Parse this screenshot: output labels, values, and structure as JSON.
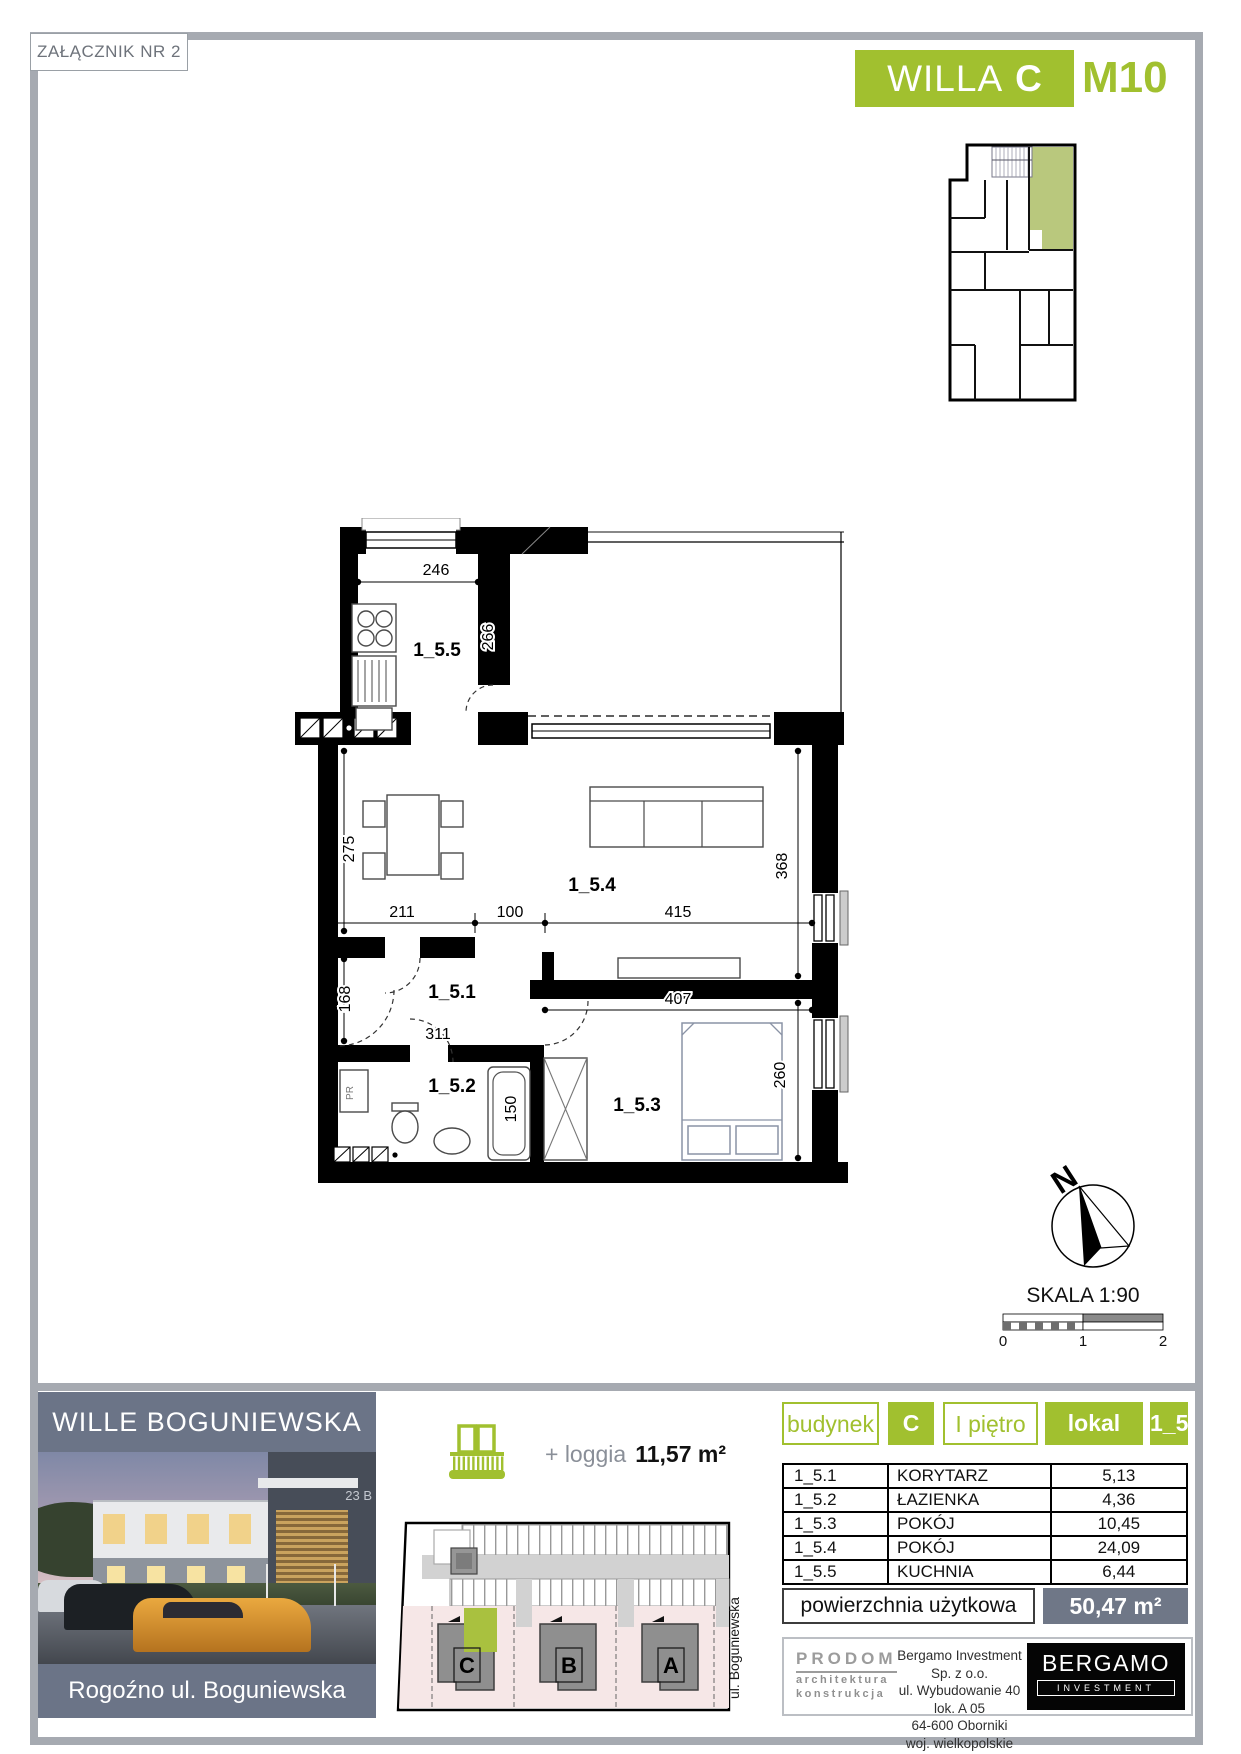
{
  "page": {
    "attachment": "ZAŁĄCZNIK NR 2"
  },
  "header": {
    "project": "WILLA",
    "building": "C",
    "unit": "M10"
  },
  "floorplan": {
    "rooms": {
      "kitchen": "1_5.5",
      "living": "1_5.4",
      "hall": "1_5.1",
      "bath": "1_5.2",
      "bedroom": "1_5.3"
    },
    "dims": {
      "kitchen_w": "246",
      "kitchen_h": "266",
      "living_h_left": "275",
      "living_h_right": "368",
      "seg_left": "211",
      "seg_mid": "100",
      "seg_right": "415",
      "hall_h": "168",
      "hall_w": "311",
      "tub": "150",
      "bedroom_w": "407",
      "bedroom_h": "260"
    },
    "closet": "PR"
  },
  "compass": {
    "north": "N"
  },
  "scalebar": {
    "label": "SKALA 1:90",
    "t0": "0",
    "t1": "1",
    "t2": "2"
  },
  "project": {
    "name": "WILLE BOGUNIEWSKA",
    "location": "Rogoźno ul. Boguniewska",
    "photo_sign": "23 B"
  },
  "loggia": {
    "label": "+ loggia",
    "area": "11,57 m²"
  },
  "siteplan": {
    "street": "ul. Boguniewska",
    "b1": "C",
    "b2": "B",
    "b3": "A"
  },
  "unit": {
    "building_label": "budynek",
    "building": "C",
    "floor": "I piętro",
    "unit_label": "lokal",
    "unit": "1_5",
    "rooms": [
      {
        "id": "1_5.1",
        "name": "KORYTARZ",
        "area": "5,13"
      },
      {
        "id": "1_5.2",
        "name": "ŁAZIENKA",
        "area": "4,36"
      },
      {
        "id": "1_5.3",
        "name": "POKÓJ",
        "area": "10,45"
      },
      {
        "id": "1_5.4",
        "name": "POKÓJ",
        "area": "24,09"
      },
      {
        "id": "1_5.5",
        "name": "KUCHNIA",
        "area": "6,44"
      }
    ],
    "total_label": "powierzchnia użytkowa",
    "total": "50,47 m²"
  },
  "footer": {
    "studio": {
      "name": "PRODOM",
      "sub1": "architektura",
      "sub2": "konstrukcja"
    },
    "developer": [
      "Bergamo Investment Sp. z o.o.",
      "ul. Wybudowanie 40 lok. A 05",
      "64-600 Oborniki",
      "woj. wielkopolskie"
    ],
    "brand": {
      "name": "BERGAMO",
      "sub": "INVESTMENT"
    }
  },
  "colors": {
    "green": "#a1c02f",
    "slate": "#6b7487",
    "frame": "#a6aab1",
    "highlight": "#a9c13f",
    "site_pink": "#f6e7e7"
  }
}
